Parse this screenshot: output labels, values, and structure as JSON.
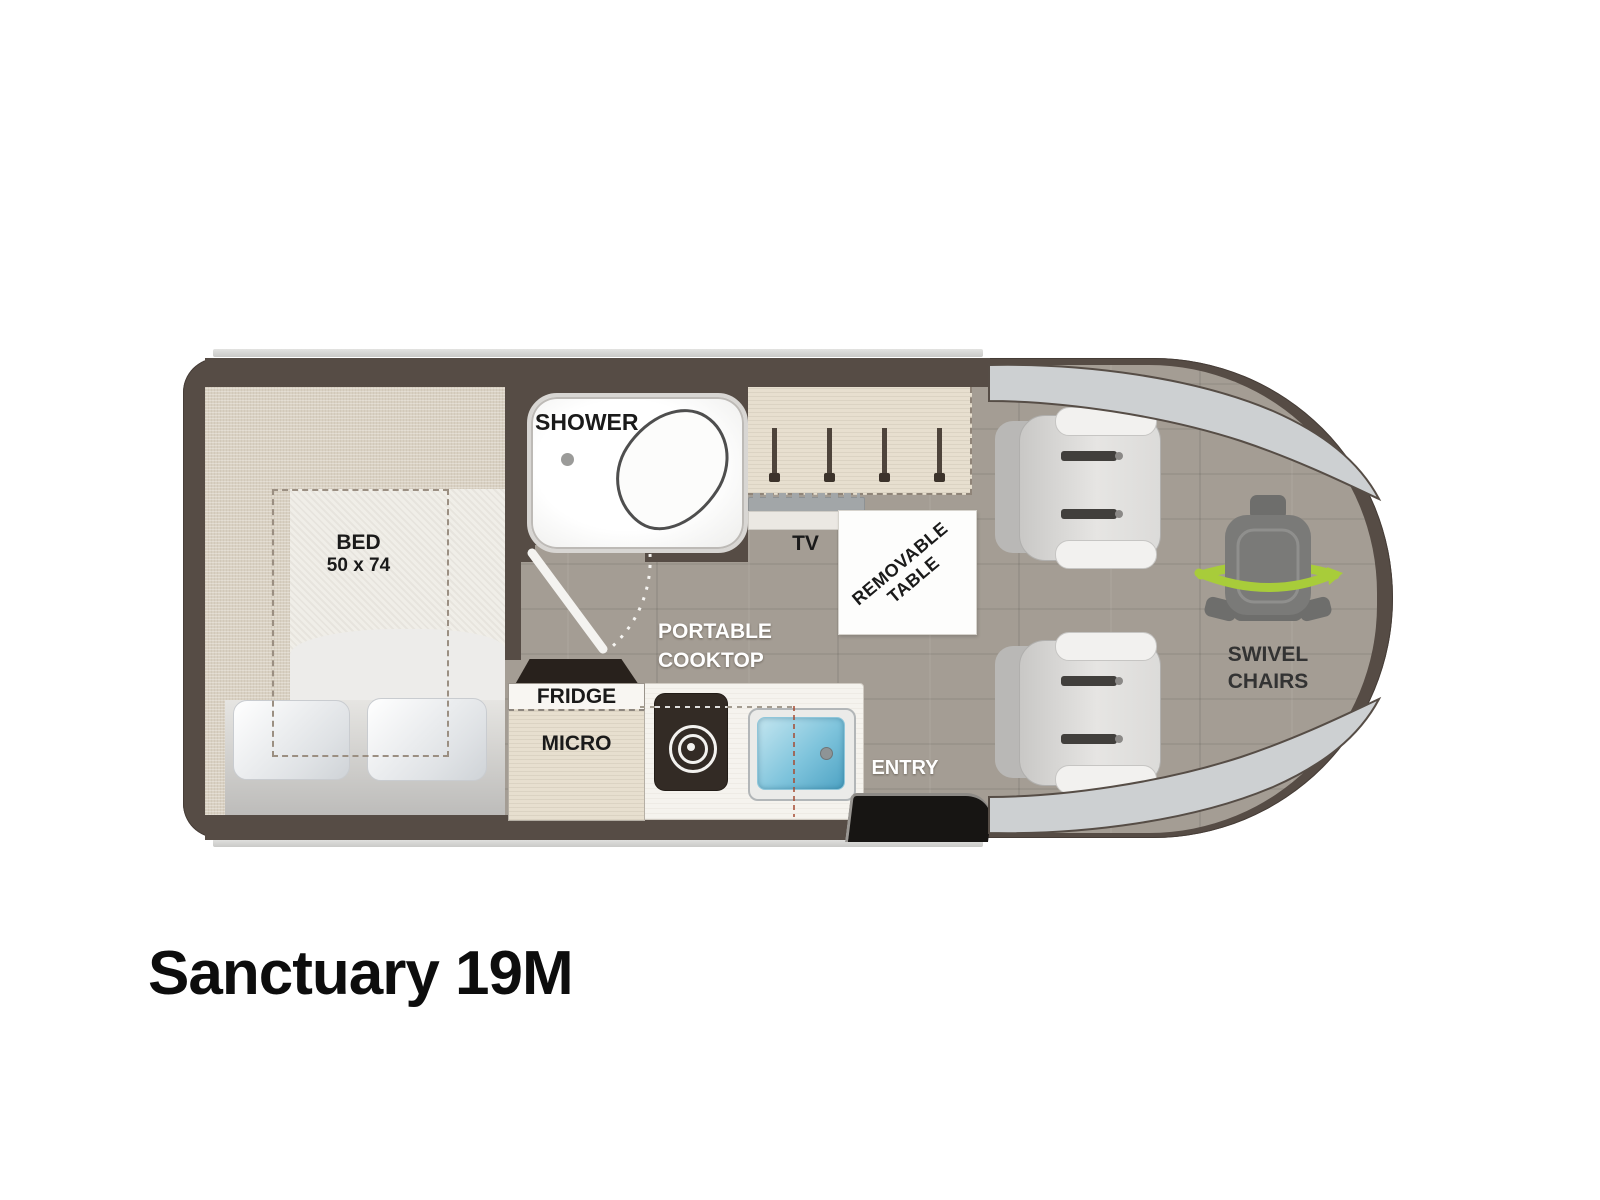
{
  "title": "Sanctuary 19M",
  "labels": {
    "shower": "SHOWER",
    "bed_line1": "BED",
    "bed_line2": "50 x 74",
    "tv": "TV",
    "removable_table_line1": "REMOVABLE",
    "removable_table_line2": "TABLE",
    "portable_cooktop_line1": "PORTABLE",
    "portable_cooktop_line2": "COOKTOP",
    "fridge": "FRIDGE",
    "micro": "MICRO",
    "entry": "ENTRY",
    "swivel_line1": "SWIVEL",
    "swivel_line2": "CHAIRS"
  },
  "colors": {
    "wall": "#564c45",
    "floor_gray": "#a49d94",
    "bedroom_beige": "#d9d1c3",
    "accent_green": "#a8cc3a",
    "sink_blue": "#7fc4dc",
    "label_black": "#1a1a1a",
    "label_white": "#ffffff"
  },
  "icons": {
    "shower_pan": "shower-pan-icon",
    "toilet": "toilet-oval-icon",
    "wardrobe_rods": "hanging-rod-icon",
    "tv_unit": "tv-icon",
    "cooktop_burner": "burner-icon",
    "sink": "sink-icon",
    "bed_pillows": "pillow-icon",
    "swivel_chair": "swivel-chair-icon",
    "captain_chair": "captain-chair-icon",
    "entry_step": "entry-step-icon"
  }
}
